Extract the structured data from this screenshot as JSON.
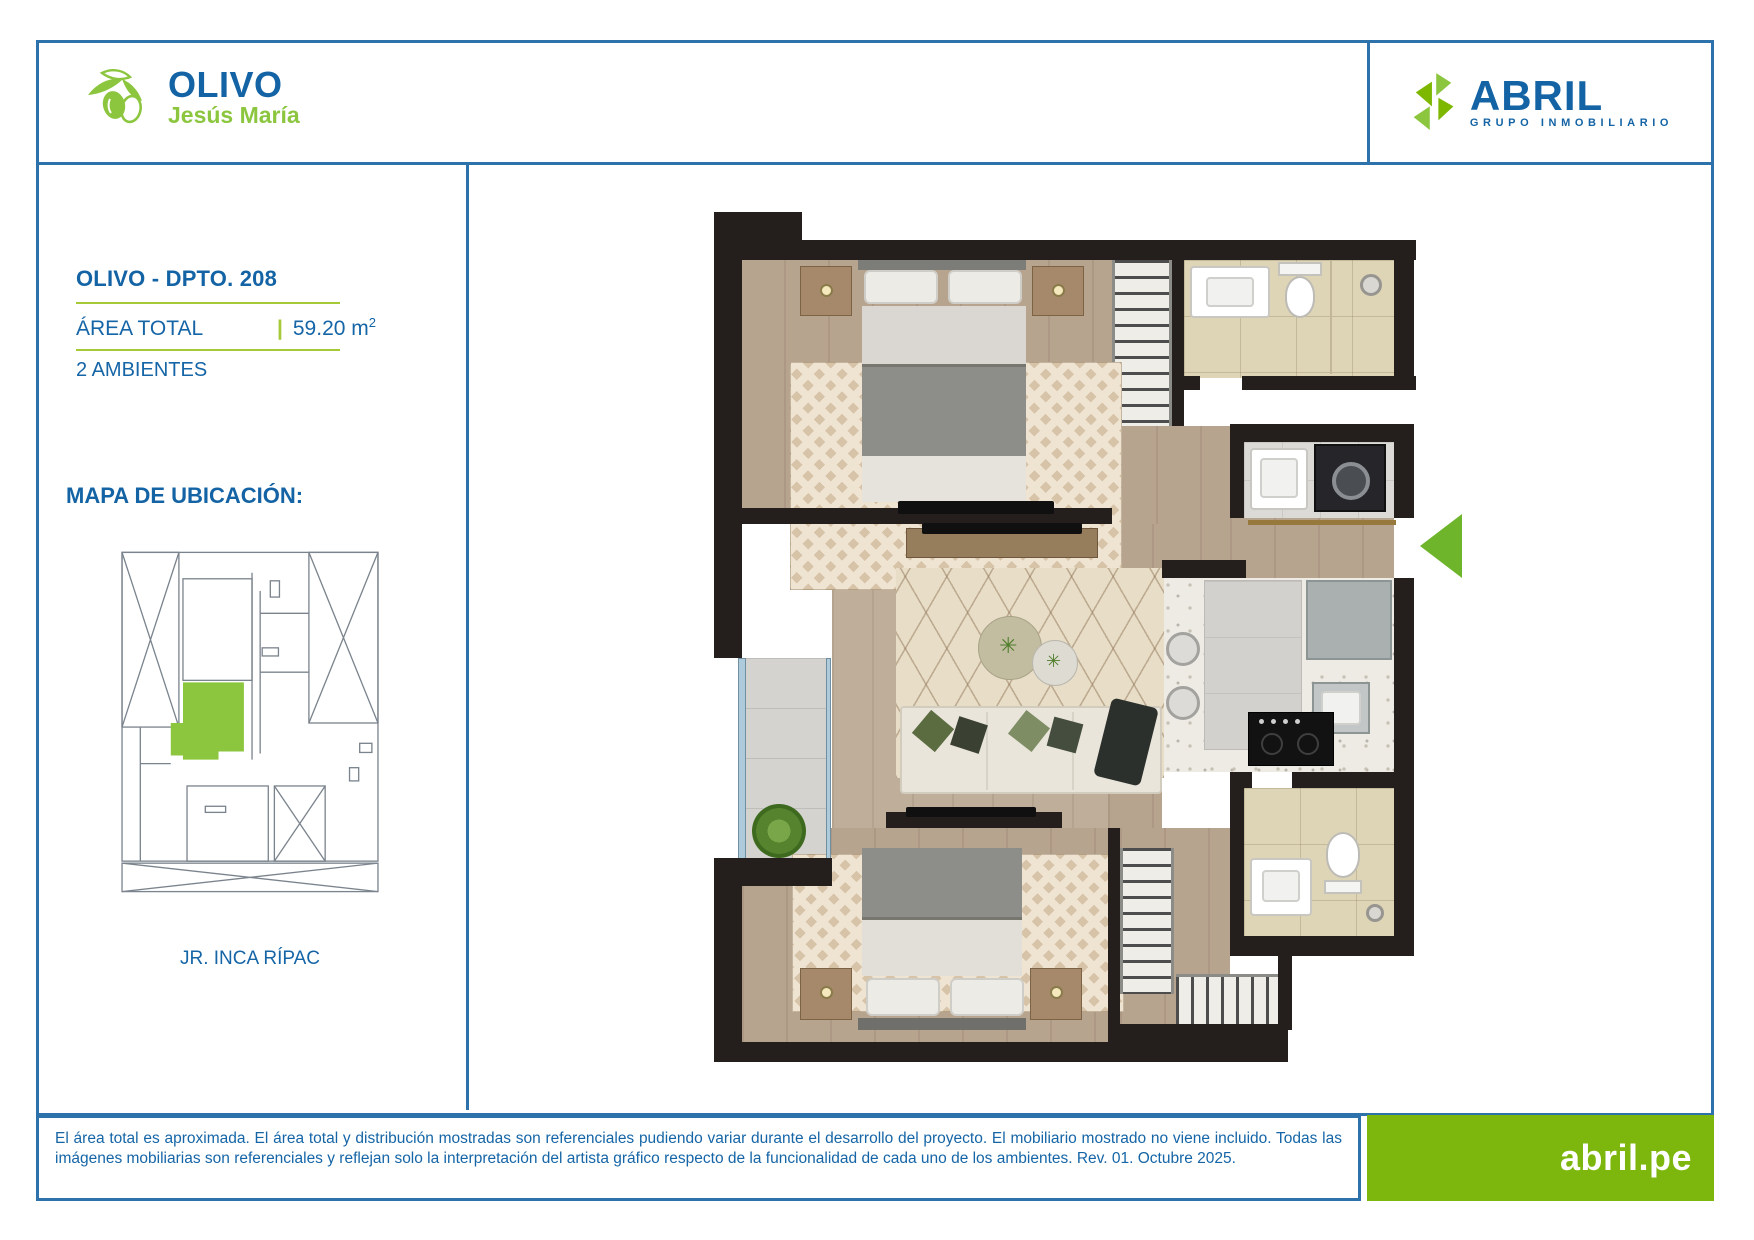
{
  "header": {
    "olivo": {
      "name": "OLIVO",
      "district": "Jesús María",
      "icon": "olive-branch-icon"
    },
    "abril": {
      "name": "ABRIL",
      "tagline": "GRUPO INMOBILIARIO",
      "icon": "leaf-sprig-icon"
    }
  },
  "panel": {
    "unit_title": "OLIVO - DPTO. 208",
    "area_label": "ÁREA TOTAL",
    "area_separator": "|",
    "area_value": "59.20 m",
    "area_sup": "2",
    "rooms_label": "2 AMBIENTES",
    "map_title": "MAPA DE UBICACIÓN:",
    "street_label": "JR. INCA RÍPAC",
    "map_highlight_color": "#8cc63f"
  },
  "floorplan": {
    "entrance_arrow_color": "#6eb52c",
    "rooms": [
      "bedroom-1",
      "closet-1",
      "bathroom-1",
      "laundry",
      "entry-hall",
      "corridor",
      "living-dining",
      "balcony",
      "kitchen",
      "bathroom-2",
      "bedroom-2",
      "closet-2"
    ]
  },
  "footer": {
    "disclaimer": "El área total es aproximada. El área total y distribución mostradas son referenciales pudiendo variar durante el desarrollo del proyecto. El mobiliario mostrado no viene incluido. Todas las imágenes mobiliarias son referenciales y reflejan solo la interpretación del artista gráfico respecto de la funcionalidad de cada uno de los ambientes. Rev. 01. Octubre 2025.",
    "website": "abril.pe"
  },
  "colors": {
    "brand_blue": "#1464a5",
    "brand_green": "#8cc63f",
    "line_blue": "#2e72ab",
    "rule_green": "#a6c937",
    "site_green": "#7db70d"
  }
}
